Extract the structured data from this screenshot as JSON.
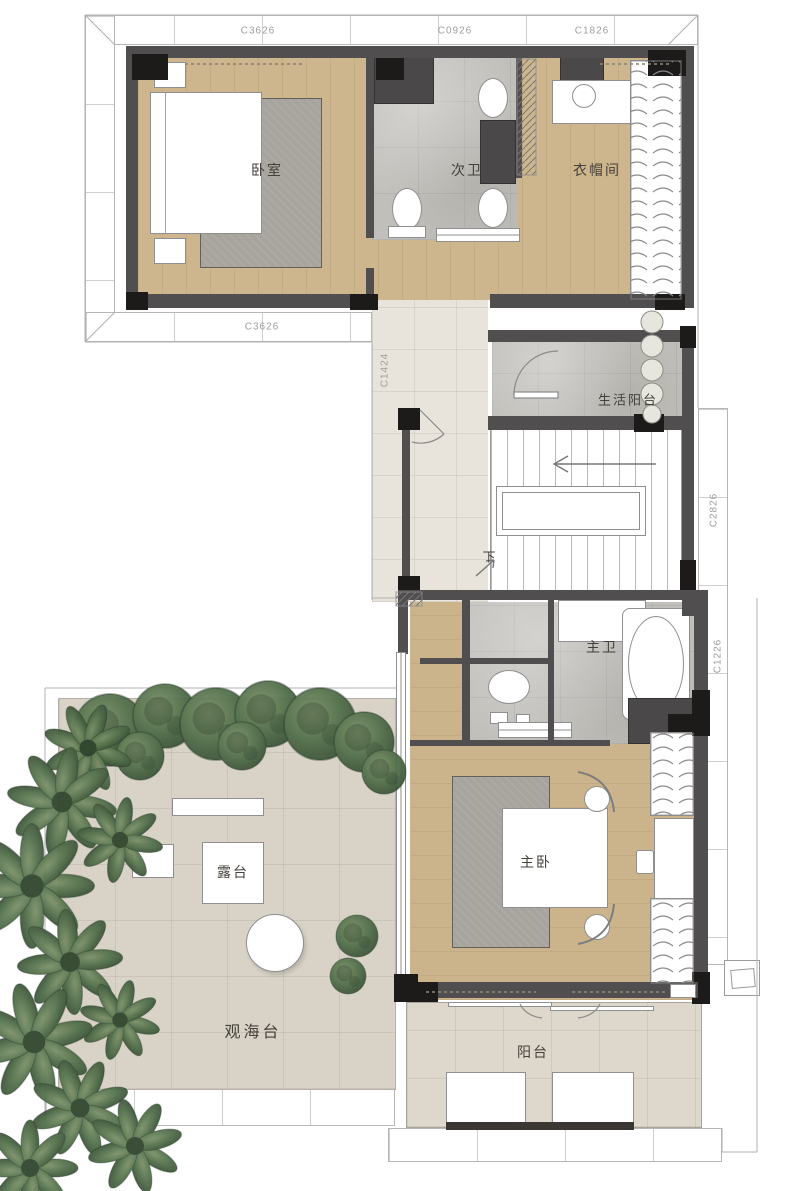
{
  "plan": {
    "rooms": {
      "bedroom2": "卧室",
      "bath2": "次卫",
      "cloakroom": "衣帽间",
      "service_balcony": "生活阳台",
      "stair_down": "下",
      "master_bath": "主卫",
      "master_bedroom": "主卧",
      "terrace": "露台",
      "sea_view_deck": "观海台",
      "balcony": "阳台"
    },
    "window_tags": {
      "top_left": "C3626",
      "top_mid": "C0926",
      "top_right": "C1826",
      "wing_bottom": "C3626",
      "corridor": "C1424",
      "stair_side": "C2826",
      "bath_side": "C1226"
    },
    "palette": {
      "wood_floor": "#cdb68e",
      "marble_floor": "#c1bfba",
      "outdoor_tile": "#d9d3c7",
      "balcony_tile": "#ded7cb",
      "corridor_tile": "#e9e4db",
      "wall": "#514e4f",
      "column": "#1c1b1a",
      "foliage": "#4f6b4a",
      "rug": "#a7a39d",
      "dim_text": "#9e9e9e",
      "label_text": "#44403a"
    }
  }
}
